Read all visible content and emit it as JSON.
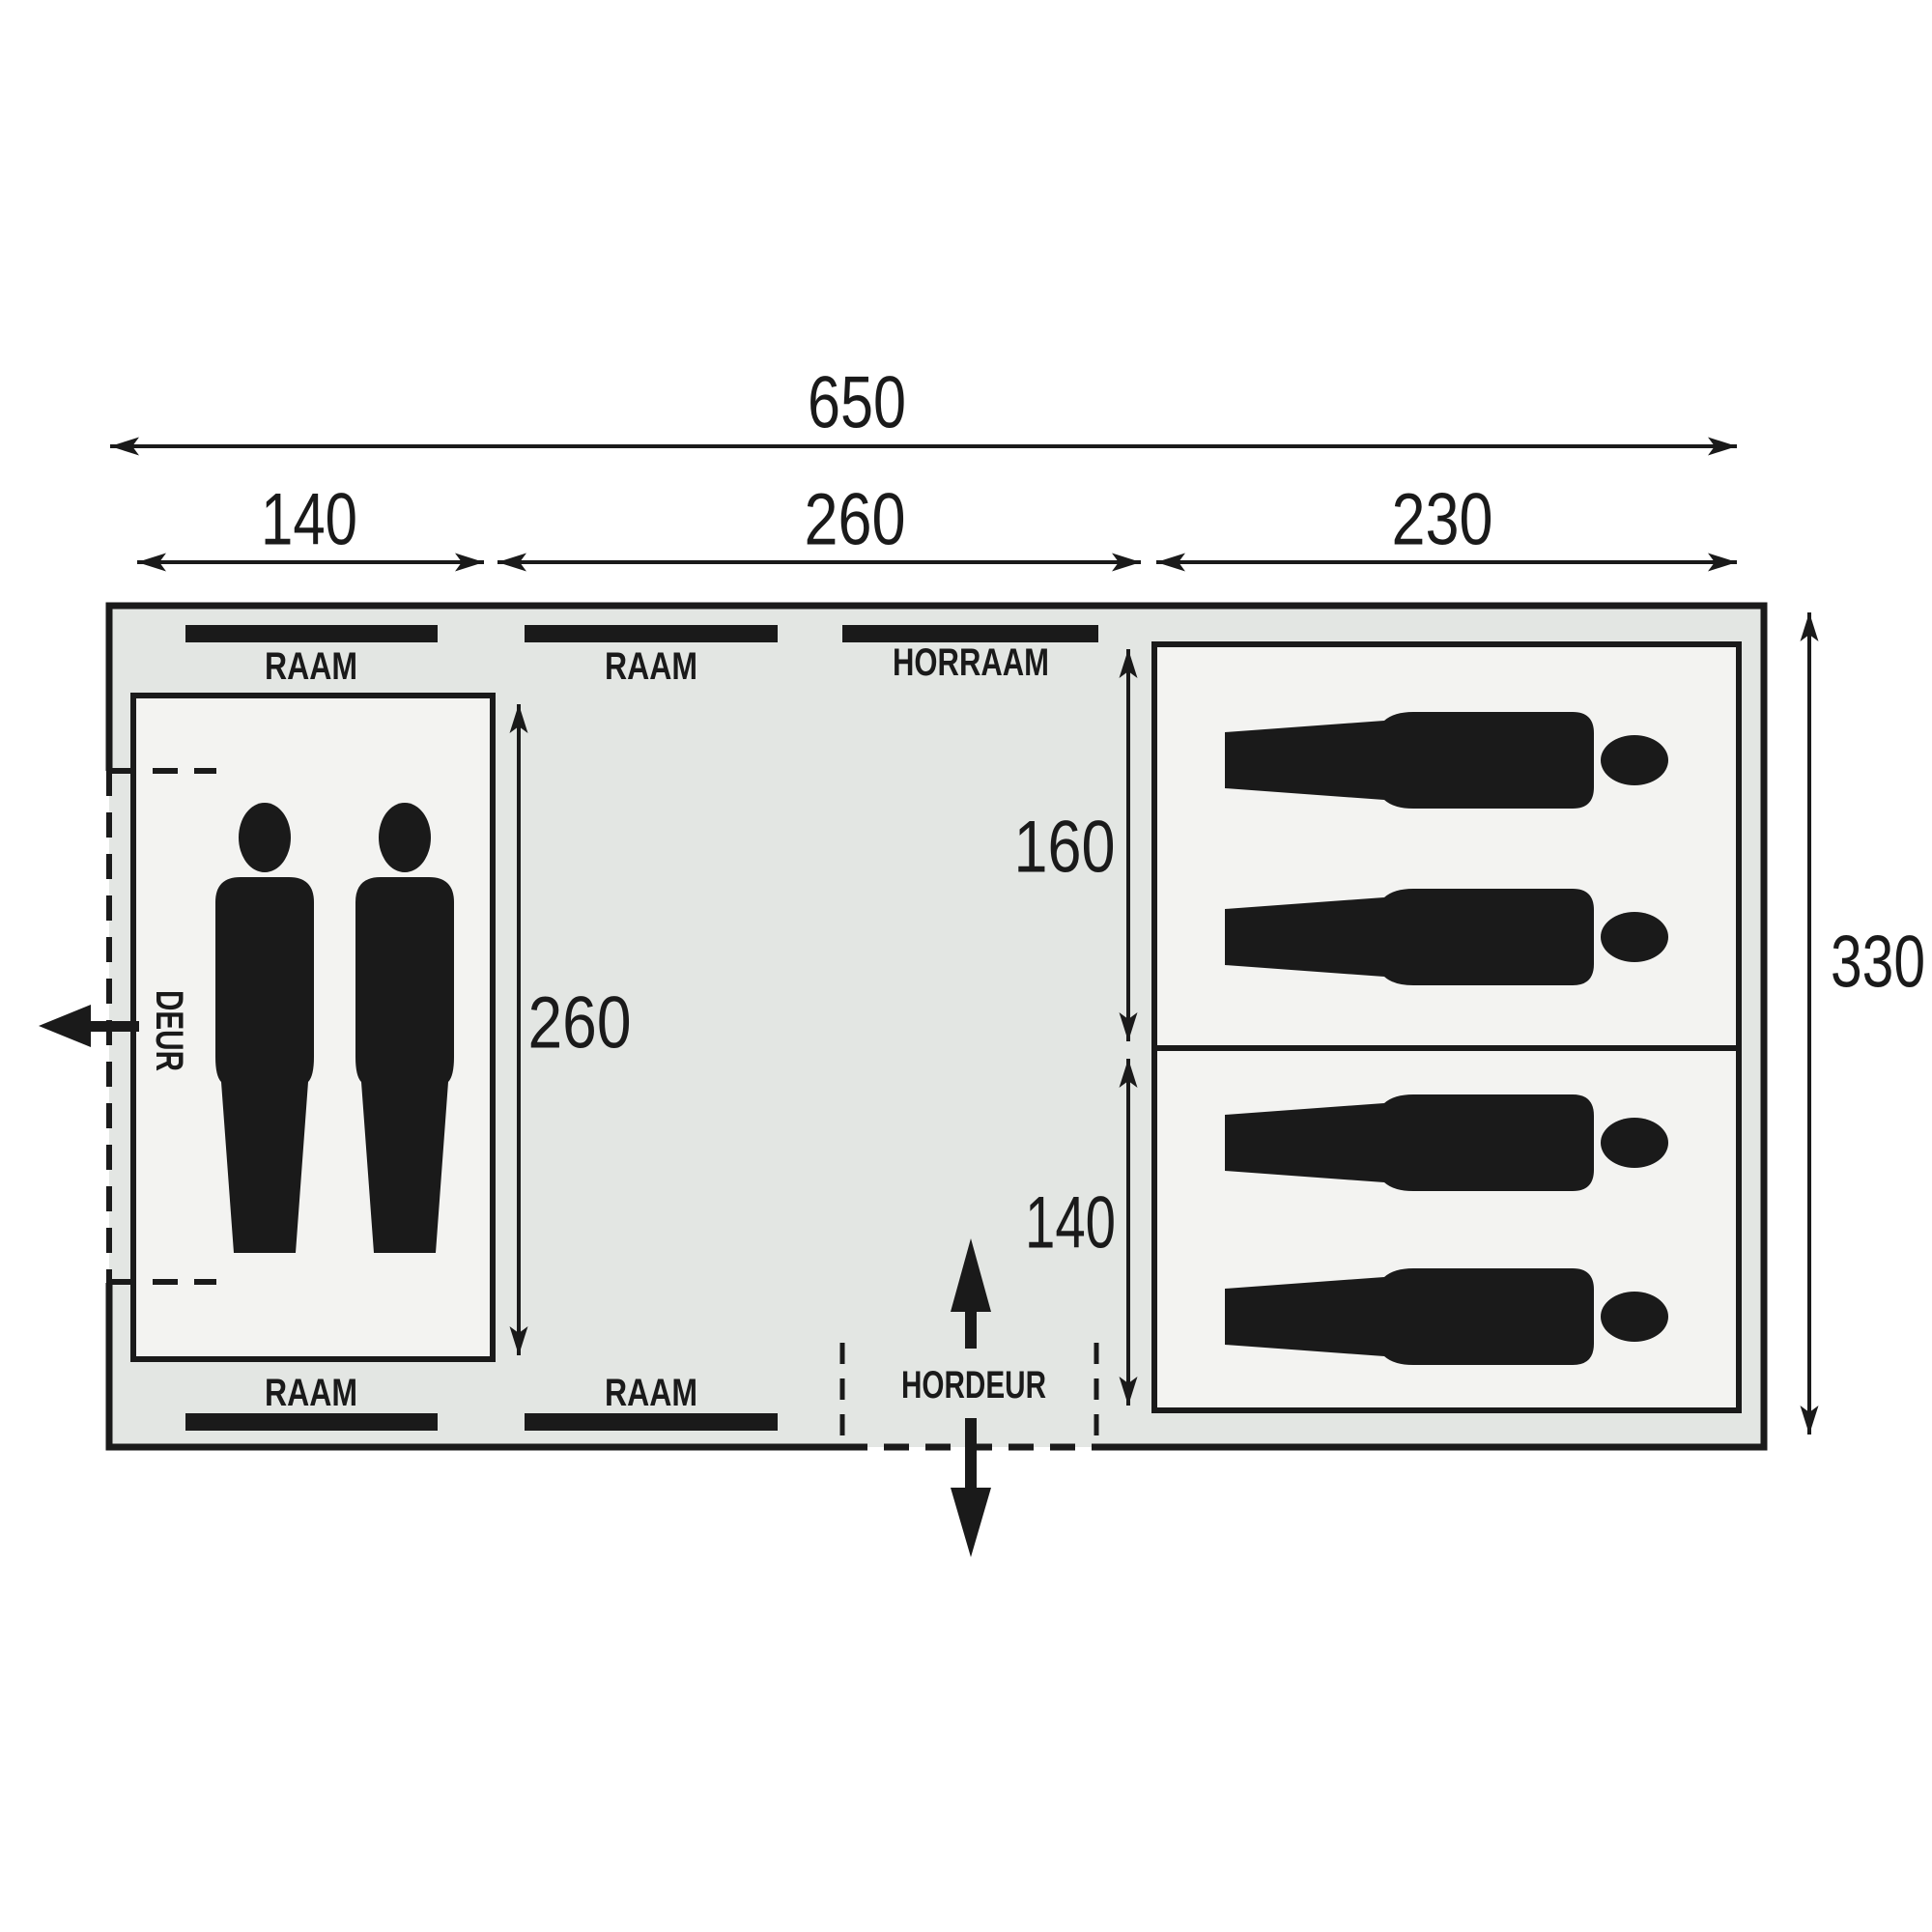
{
  "diagram": {
    "type": "tent-floorplan",
    "dim_labels": {
      "total_width": "650",
      "cabin_width": "140",
      "living_width": "260",
      "sleeping_width": "230",
      "total_depth": "330",
      "living_depth": "260",
      "sleep_section_top": "160",
      "sleep_section_bottom": "140"
    },
    "windows_top": [
      "RAAM",
      "RAAM",
      "HORRAAM"
    ],
    "windows_bottom": [
      "RAAM",
      "RAAM"
    ],
    "door": "DEUR",
    "screen_door": "HORDEUR",
    "occupants": {
      "standing_persons": 2,
      "sleeping_persons": 4
    },
    "colors": {
      "canvas": "#ffffff",
      "tent_fill": "#e3e6e3",
      "room_fill": "#f3f3f1",
      "ink": "#1a1a1a"
    }
  }
}
